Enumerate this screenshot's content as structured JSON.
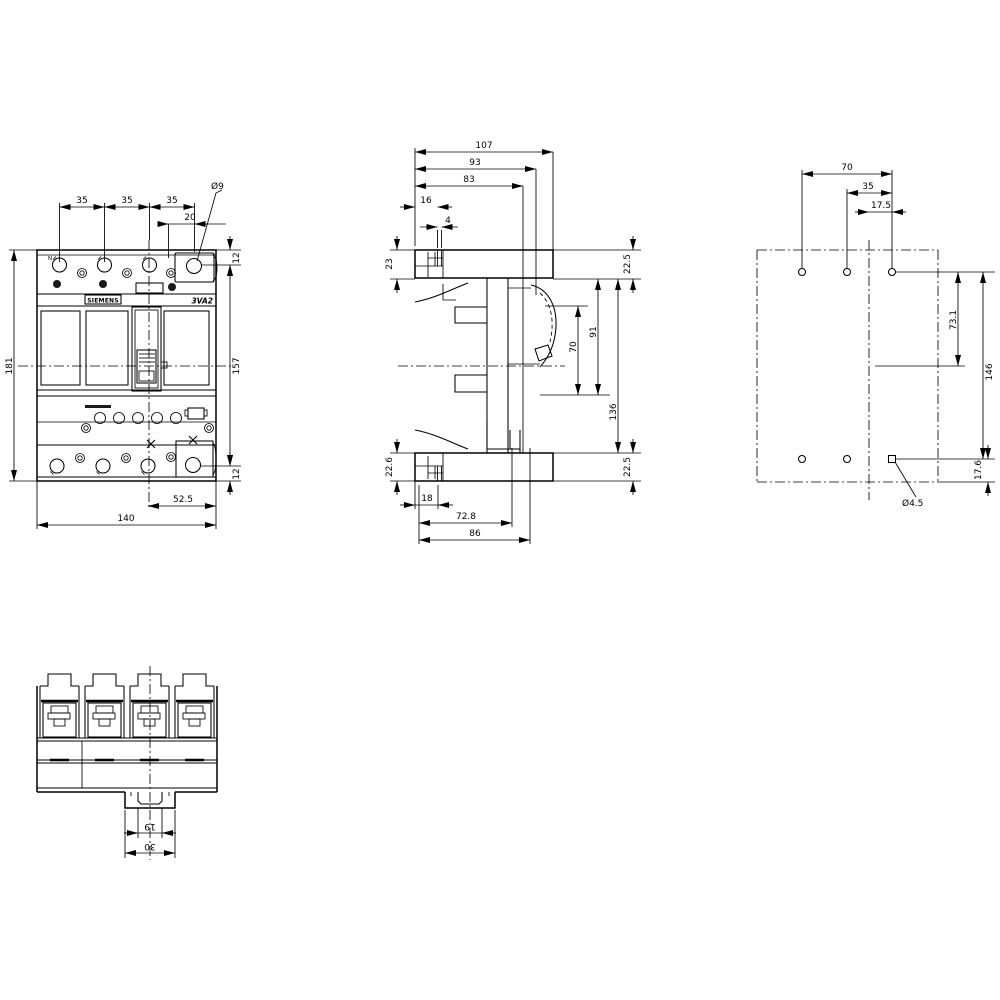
{
  "drawing": {
    "brand_label": "SIEMENS",
    "product_label": "3VA2",
    "front": {
      "neutral_label": "N",
      "pitch1": "35",
      "pitch2": "35",
      "pitch3": "35",
      "terminal_offset": "20",
      "terminal_hole_dia": "Ø9",
      "top_offset": "12",
      "inner_height": "157",
      "total_height": "181",
      "bottom_offset": "12",
      "center_to_edge": "52.5",
      "total_width": "140"
    },
    "side": {
      "total_depth": "107",
      "depth_93": "93",
      "depth_83": "83",
      "slot_offset": "16",
      "slot_width": "4",
      "top_left": "23",
      "top_cover": "22.5",
      "handle_window": "70",
      "handle_zone": "91",
      "body_height": "136",
      "bottom_cover": "22.5",
      "bottom_left": "22.6",
      "rail_offset": "18",
      "depth_72_8": "72.8",
      "depth_86": "86"
    },
    "drill": {
      "hole_span": "70",
      "hole_half_span": "35",
      "center_offset": "17.5",
      "row_offset": "73.1",
      "row_span": "146",
      "bottom_offset": "17.6",
      "hole_dia": "Ø4.5"
    },
    "bottom": {
      "foot_inner": "19",
      "foot_outer": "30"
    }
  }
}
